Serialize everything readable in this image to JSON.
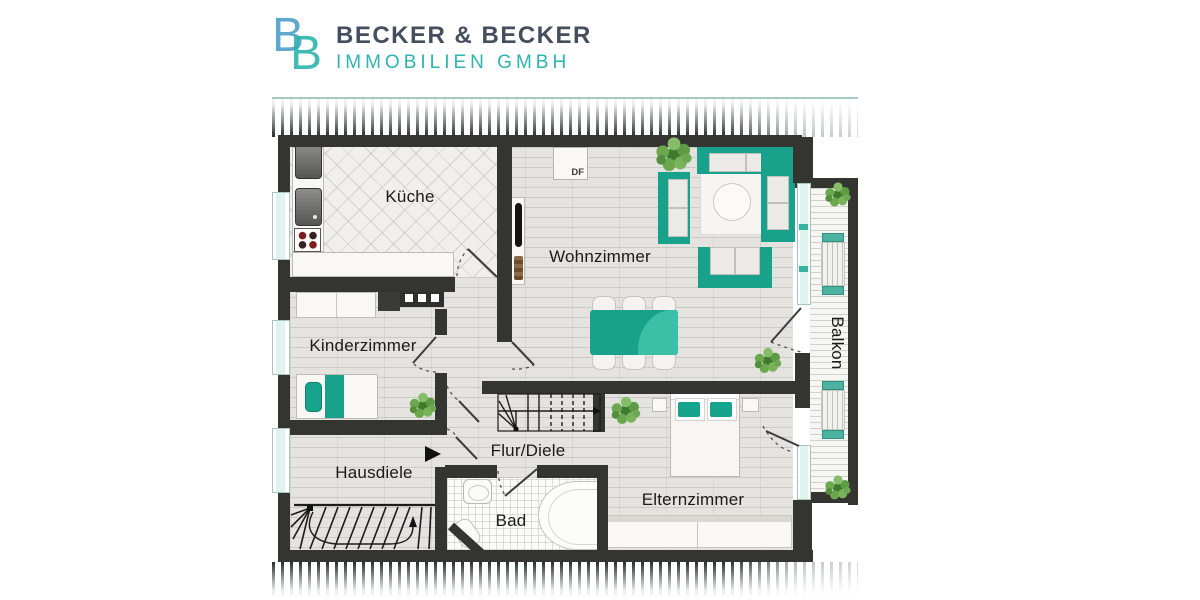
{
  "brand": {
    "monogram_b1": "B",
    "monogram_b2": "B",
    "name": "BECKER & BECKER",
    "tagline": "IMMOBILIEN GMBH"
  },
  "rooms": {
    "kitchen": "Küche",
    "living_room": "Wohnzimmer",
    "children_room": "Kinderzimmer",
    "entrance_hall": "Hausdiele",
    "corridor": "Flur/Diele",
    "bathroom": "Bad",
    "parents_room": "Elternzimmer",
    "balcony": "Balkon"
  },
  "annotations": {
    "roof_window_label": "DF"
  },
  "colors": {
    "furniture_teal": "#18a28b",
    "logo_blue": "#4f9fc9",
    "logo_teal": "#2eb4ae",
    "logo_dark_text": "#454e5c",
    "wall_dark": "#343431",
    "window_glass": "#dff3ef",
    "plant_green": "#6aa74d"
  }
}
